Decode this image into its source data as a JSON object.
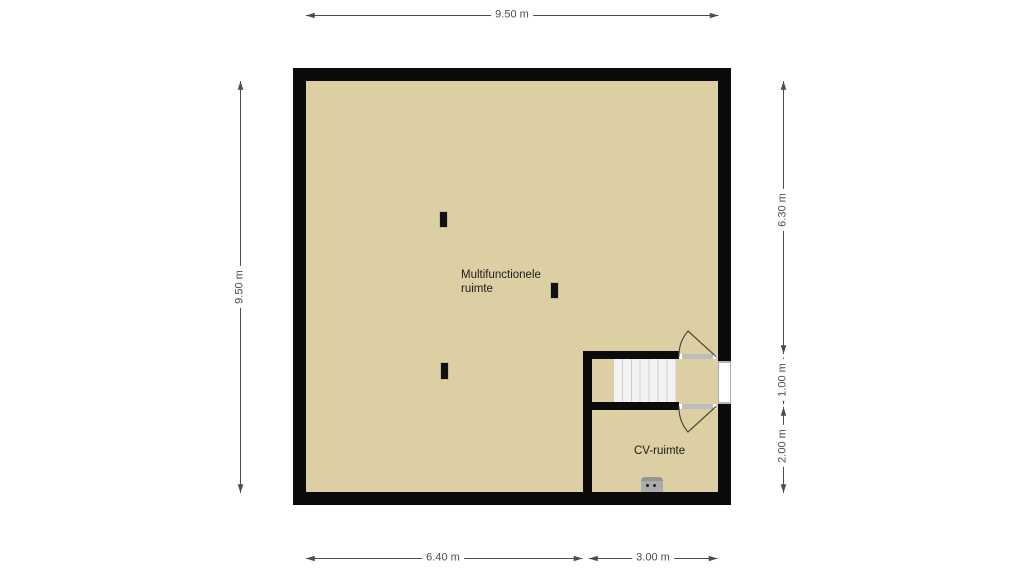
{
  "floor_plan": {
    "rooms": [
      {
        "label": "Multifunctionele ruimte"
      },
      {
        "label": "CV-ruimte"
      }
    ],
    "features": [
      {
        "name": "stairs",
        "treads": 7
      },
      {
        "name": "door-top-swing"
      },
      {
        "name": "door-bottom-swing"
      },
      {
        "name": "window-right"
      },
      {
        "name": "cv-boiler"
      },
      {
        "name": "column-markers",
        "count": 3
      }
    ],
    "colors": {
      "floor": "#dccfa3",
      "wall": "#0b0b0b",
      "stairs_fill": "#f2f2f2",
      "stairs_line": "#cdcdcd",
      "door_line": "#4f4a3c",
      "dimension_line": "#4d4d4d",
      "appliance": "#ababab"
    }
  },
  "dimensions": {
    "top": {
      "label": "9.50 m"
    },
    "left": {
      "label": "9.50 m"
    },
    "right": [
      {
        "label": "6.30 m"
      },
      {
        "label": "1.00 m"
      },
      {
        "label": "2.00 m"
      }
    ],
    "bottom": [
      {
        "label": "6.40 m"
      },
      {
        "label": "3.00 m"
      }
    ]
  }
}
